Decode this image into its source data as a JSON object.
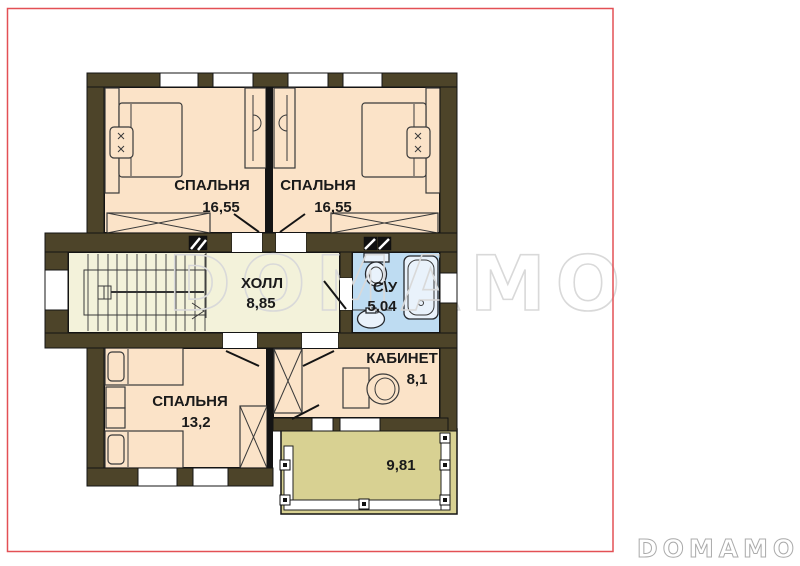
{
  "colors": {
    "wall": "#4d4429",
    "outline": "#141414",
    "floor-room": "#fbe3c8",
    "floor-hall": "#f3f2da",
    "floor-bath": "#bedcf2",
    "floor-balcony": "#d8d192",
    "fixture": "#e9f2fb",
    "watermark": "#d9d9d9",
    "logo": "#ababab",
    "border": "#e35055",
    "label": "#1a1a1a"
  },
  "rooms": {
    "bedroom_top_left": {
      "label": "СПАЛЬНЯ",
      "area": "16,55"
    },
    "bedroom_top_right": {
      "label": "СПАЛЬНЯ",
      "area": "16,55"
    },
    "hall": {
      "label": "ХОЛЛ",
      "area": "8,85"
    },
    "bathroom": {
      "label": "С\\У",
      "area": "5,04"
    },
    "office": {
      "label": "КАБИНЕТ",
      "area": "8,1"
    },
    "bedroom_bottom": {
      "label": "СПАЛЬНЯ",
      "area": "13,2"
    },
    "balcony": {
      "area": "9,81"
    }
  },
  "watermark": {
    "text": "DOMAMO"
  },
  "logo": {
    "text": "DOMAMO"
  }
}
